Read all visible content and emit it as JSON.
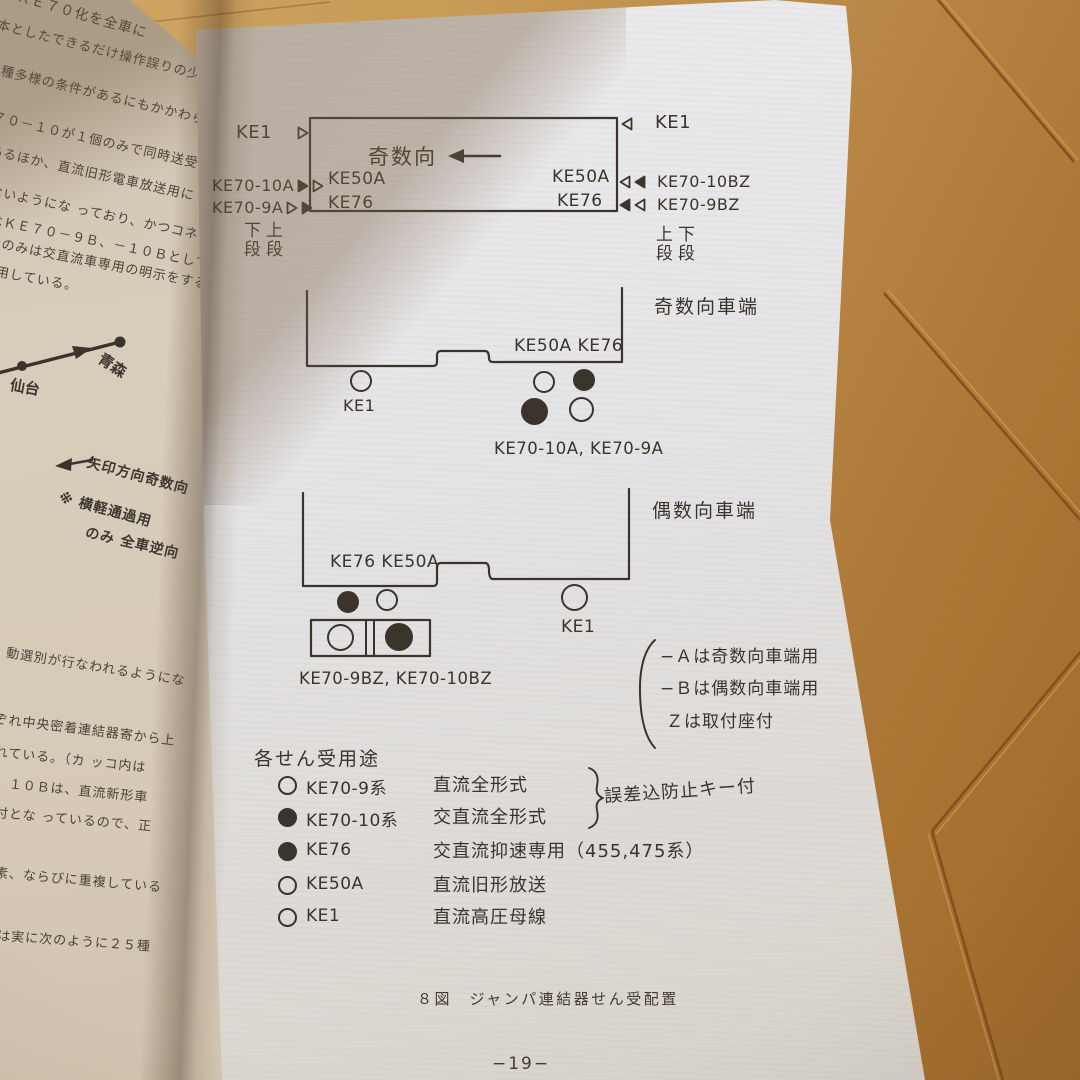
{
  "colors": {
    "ink": "#3a342d",
    "paper_right": "#e6e5e7",
    "paper_left": "#d6cbb8",
    "floor": "#bd8a45",
    "floor_seam": "#7d4b1c",
    "shadow_tint": "#80674a"
  },
  "left_page": {
    "fragments": [
      "ＫＥ７０化を全車に",
      "本としたできるだけ操作誤りの少ない",
      "多種多様の条件があるにもかかわらず",
      "７０－１０が１個のみで同時送受電",
      "あるほか、直流旧形電車放送用に",
      "ないようにな っており、かつコネ",
      "はＫＥ７０－９Ｂ、－１０Ｂとして",
      "受のみは交直流車専用の明示をする",
      "用している。"
    ],
    "map": {
      "station_left": "仙台",
      "station_right": "青森"
    },
    "notes": [
      "矢印方向奇数向",
      "※ 横軽通過用",
      "のみ 全車逆向"
    ],
    "lower_fragments": [
      "動選別が行なわれるようにな",
      "ぞれ中央密着連結器寄から上",
      "れている。（カ ッコ内は",
      "、１０Ｂは、直流新形車",
      "付とな っているので、正",
      "素、ならびに重複している",
      "は実に次のように２５種"
    ]
  },
  "diagram": {
    "top": {
      "direction": "奇数向",
      "inside_left": [
        "KE50A",
        "KE76"
      ],
      "inside_right": [
        "KE50A",
        "KE76"
      ],
      "left": {
        "ke1": "KE1",
        "row1_label": "KE70-10A",
        "row2_label": "KE70-9A",
        "row1_pins": [
          "filled",
          "open"
        ],
        "row2_pins": [
          "open",
          "filled"
        ],
        "caption1": "下上",
        "caption2": "段段"
      },
      "right": {
        "ke1": "KE1",
        "row1_label": "KE70-10BZ",
        "row2_label": "KE70-9BZ",
        "row1_pins": [
          "open",
          "filled"
        ],
        "row2_pins": [
          "filled",
          "open"
        ],
        "caption1": "上下",
        "caption2": "段段"
      }
    },
    "odd_end": {
      "title": "奇数向車端",
      "socket_label": "KE50A  KE76",
      "ke1": "KE1",
      "ke1_pin": "open",
      "pins": [
        "open",
        "filled",
        "filled",
        "open"
      ],
      "group_label": "KE70-10A, KE70-9A"
    },
    "even_end": {
      "title": "偶数向車端",
      "socket_label": "KE76  KE50A",
      "left_pins": [
        "filled",
        "open"
      ],
      "box_pins": [
        "open",
        "filled"
      ],
      "ke1": "KE1",
      "ke1_pin": "open",
      "group_label": "KE70-9BZ, KE70-10BZ"
    },
    "suffix_notes": [
      "−Ａは奇数向車端用",
      "−Ｂは偶数向車端用",
      "Ｚは取付座付"
    ],
    "legend": {
      "title": "各せん受用途",
      "rows": [
        {
          "pin": "open",
          "name": "KE70-9系",
          "desc": "直流全形式"
        },
        {
          "pin": "filled",
          "name": "KE70-10系",
          "desc": "交直流全形式"
        },
        {
          "pin": "filled",
          "name": "KE76",
          "desc": "交直流抑速専用（455,475系）"
        },
        {
          "pin": "open",
          "name": "KE50A",
          "desc": "直流旧形放送"
        },
        {
          "pin": "open",
          "name": "KE1",
          "desc": "直流高圧母線"
        }
      ],
      "brace_note": "誤差込防止キー付"
    },
    "caption": "８図　ジャンパ連結器せん受配置",
    "page_number": "−19−"
  }
}
